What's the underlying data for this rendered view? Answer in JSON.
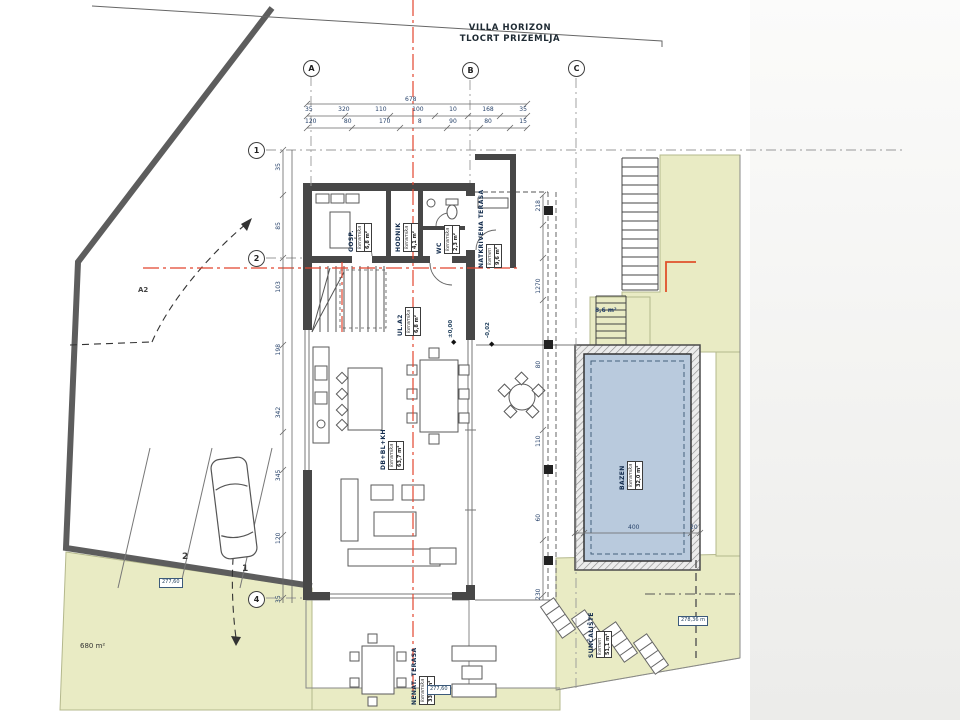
{
  "title": {
    "line1": "VILLA HORIZON",
    "line2": "TLOCRT PRIZEMLJA"
  },
  "grid": {
    "columns": [
      "A",
      "B",
      "C"
    ],
    "rows": [
      "1",
      "2",
      "4"
    ]
  },
  "rooms": [
    {
      "id": "gosp",
      "name": "GOSP.",
      "material": "keramika",
      "area": "6,8 m²"
    },
    {
      "id": "hodnik",
      "name": "HODNIK",
      "material": "keramika",
      "area": "4,1 m²"
    },
    {
      "id": "wc",
      "name": "WC",
      "material": "keramika",
      "area": "2,3 m²"
    },
    {
      "id": "natkrivena-terasa",
      "name": "NATKRIVENA TERASA",
      "material": "kamen",
      "area": "9,6 m²"
    },
    {
      "id": "ulaz",
      "name": "UL.A2",
      "material": "keramika",
      "area": "6,8 m²"
    },
    {
      "id": "dnevni-boravak",
      "name": "DB+BL+KH",
      "material": "keramika",
      "area": "63,7 m²"
    },
    {
      "id": "bazen",
      "name": "BAZEN",
      "material": "keramika",
      "area": "32,0 m²"
    },
    {
      "id": "suncaliste",
      "name": "SUNČALIŠTE",
      "material": "kamen",
      "area": "51,1 m²"
    },
    {
      "id": "nenatkrivena-terasa",
      "name": "NENAT. TERASA",
      "material": "keramika",
      "area": "33,5 m²"
    }
  ],
  "levels": {
    "main": "±0,00",
    "terrace": "-0,02"
  },
  "site": {
    "plot_area": "680 m²",
    "lawn_area": "8,6 m²",
    "axis_label": "A2",
    "parking_stalls": [
      "1",
      "2"
    ],
    "spot_elevations": {
      "parking": "277,60",
      "sun_deck": "278,36 m",
      "terrace": "277,60"
    }
  },
  "dimensions": {
    "overall_top": "678",
    "top_row_upper": [
      "35",
      "320",
      "110",
      "100",
      "10",
      "168",
      "35"
    ],
    "top_row_lower": [
      "120",
      "80",
      "170",
      "8",
      "90",
      "80",
      "15"
    ],
    "left_column": [
      "35",
      "120",
      "345",
      "342",
      "198",
      "103",
      "85",
      "35"
    ],
    "right_column": [
      "230",
      "60",
      "110",
      "80",
      "1270",
      "218"
    ],
    "pool": [
      "400",
      "20"
    ]
  },
  "colors": {
    "terrain_green": "#e9ebc4",
    "pool_blue": "#b9cadd",
    "wall_dark": "#474747",
    "axis_red": "#e2452f"
  }
}
